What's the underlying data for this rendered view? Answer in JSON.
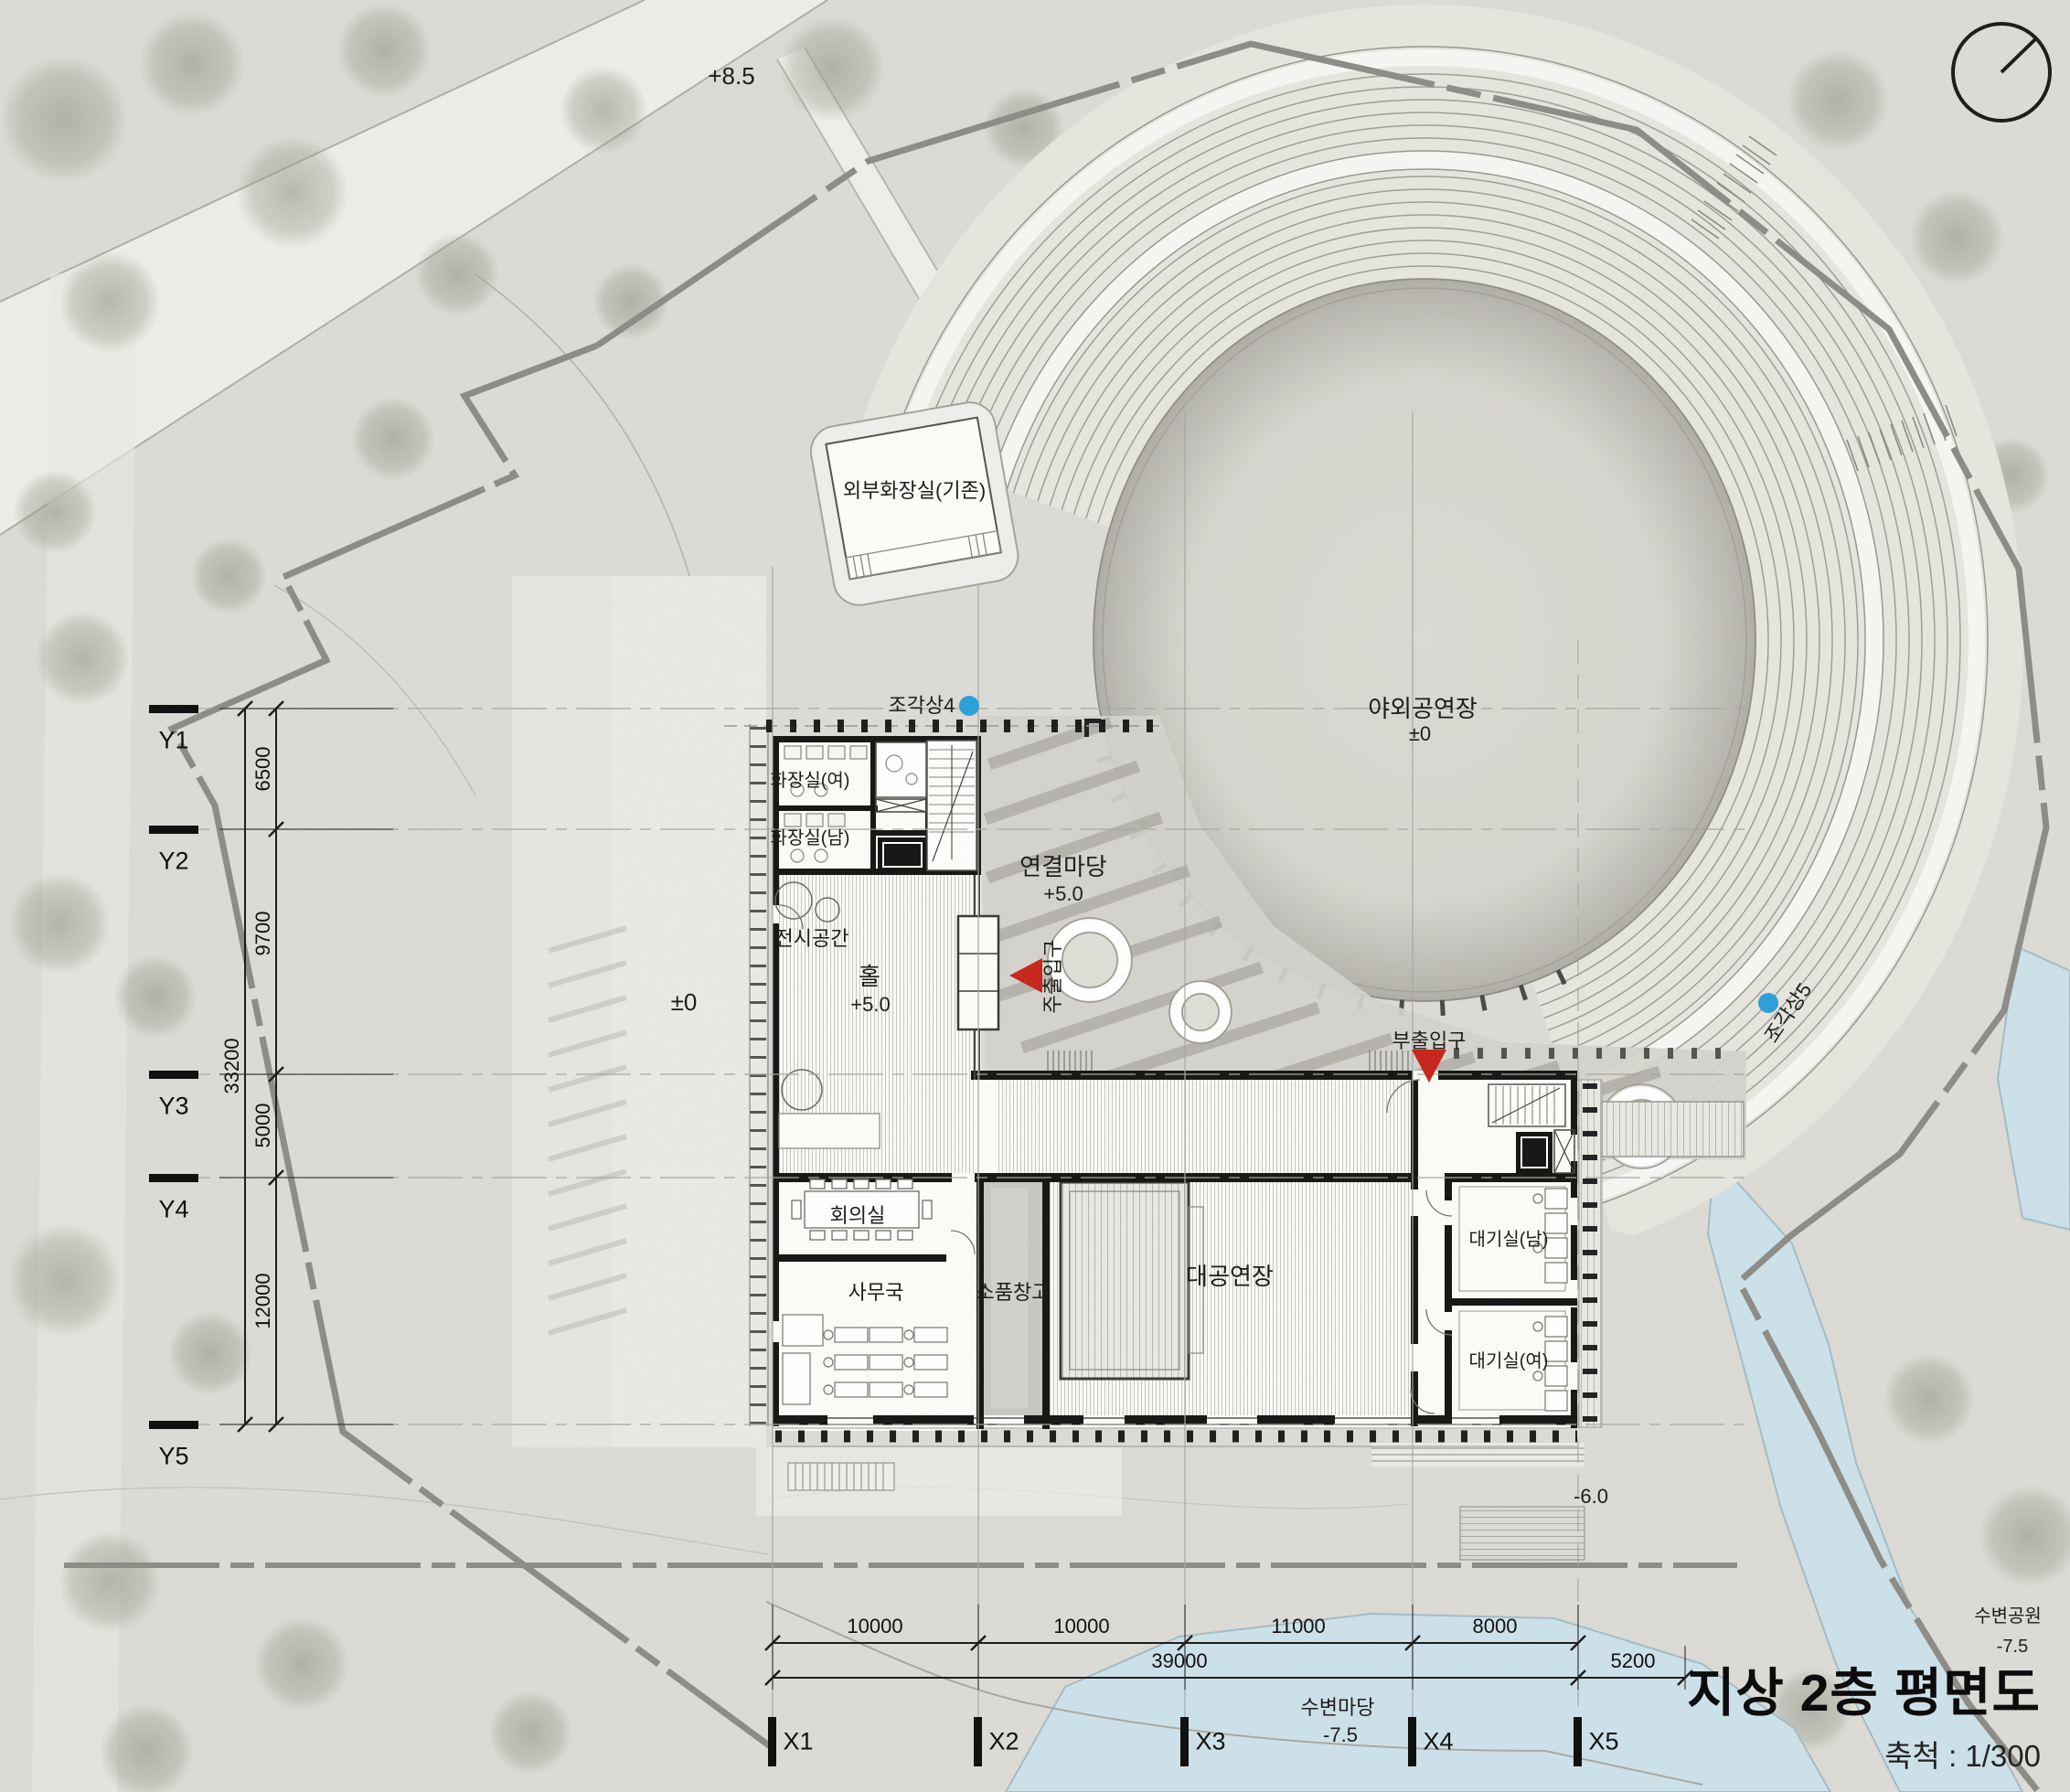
{
  "drawing": {
    "title": "지상 2층 평면도",
    "scale_label": "축척 : 1/300"
  },
  "levels": {
    "road_top": "+8.5",
    "plaza": "±0",
    "amphitheater": "±0",
    "hall": "+5.0",
    "yard": "+5.0",
    "lower_plaza": "-6.0",
    "waterfront_yard": "-7.5",
    "waterfront_park": "-7.5"
  },
  "rooms": {
    "ext_toilet": "외부화장실(기존)",
    "amphitheater": "야외공연장",
    "toilet_w": "화장실(여)",
    "toilet_m": "화장실(남)",
    "exhibition": "전시공간",
    "hall": "홀",
    "yard": "연결마당",
    "meeting": "회의실",
    "office": "사무국",
    "props": "소품창고",
    "main_theater": "대공연장",
    "waiting_m": "대기실(남)",
    "waiting_f": "대기실(여)",
    "waterfront_yard": "수변마당",
    "waterfront_park": "수변공원"
  },
  "markers": {
    "main_entrance": "주출입구",
    "sub_entrance": "부출입구",
    "sculpture4": "조각상4",
    "sculpture5": "조각상5"
  },
  "grid": {
    "x": [
      "X1",
      "X2",
      "X3",
      "X4",
      "X5"
    ],
    "y": [
      "Y1",
      "Y2",
      "Y3",
      "Y4",
      "Y5"
    ]
  },
  "dimensions": {
    "y_segments": [
      "6500",
      "9700",
      "5000",
      "12000"
    ],
    "y_total": "33200",
    "x_segments": [
      "10000",
      "10000",
      "11000",
      "8000"
    ],
    "x_total": "39000",
    "x_right": "5200"
  },
  "colors": {
    "entrance_red": "#c8251c",
    "sculpture_blue": "#2d9fd9",
    "water": "#cde1ea"
  }
}
